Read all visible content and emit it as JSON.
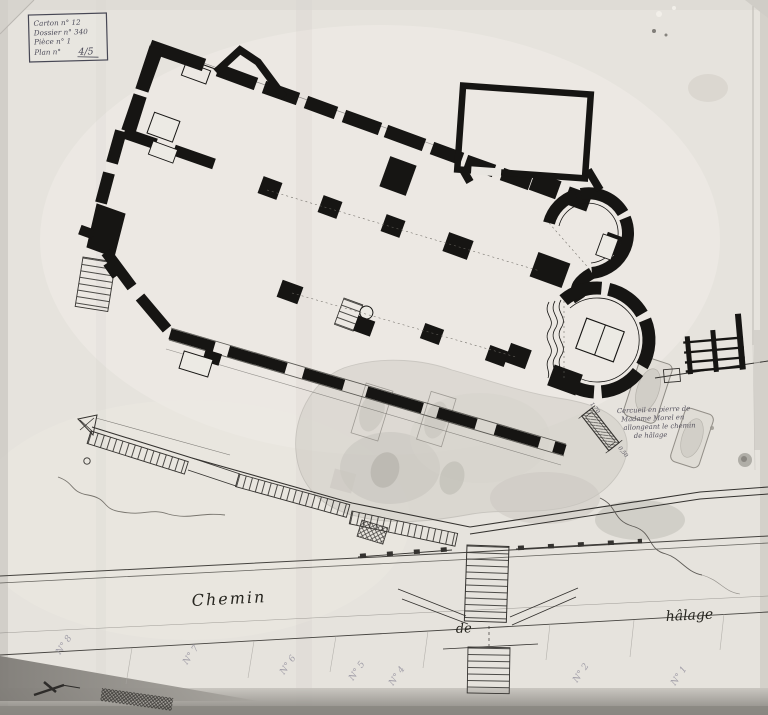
{
  "stamp_box": {
    "lines": [
      "Carton n° 12",
      "Dossier n° 340",
      "Pièce n° 1"
    ],
    "plan_label": "Plan n°",
    "plan_value": "4/5"
  },
  "annotation": {
    "lines": [
      "Cercueil en pierre de",
      "Madame Morel en",
      "allongeant le chemin",
      "de hâlage"
    ]
  },
  "coffin": {
    "dims": [
      "1,70",
      "0,50"
    ]
  },
  "road": {
    "words": [
      "Chemin",
      "de",
      "hâlage"
    ]
  },
  "plots": [
    {
      "label": "N° 8"
    },
    {
      "label": "N° 7"
    },
    {
      "label": "N° 6"
    },
    {
      "label": "N° 5"
    },
    {
      "label": "N° 4"
    },
    {
      "label": "N° 2"
    },
    {
      "label": "N° 1"
    }
  ],
  "colors": {
    "paper": "#e7e4de",
    "ink": "#161513",
    "pencil_labels": "#a19ea8",
    "excavation_wash": "#ccc9c1",
    "handwriting_ink": "#4c4b59"
  }
}
